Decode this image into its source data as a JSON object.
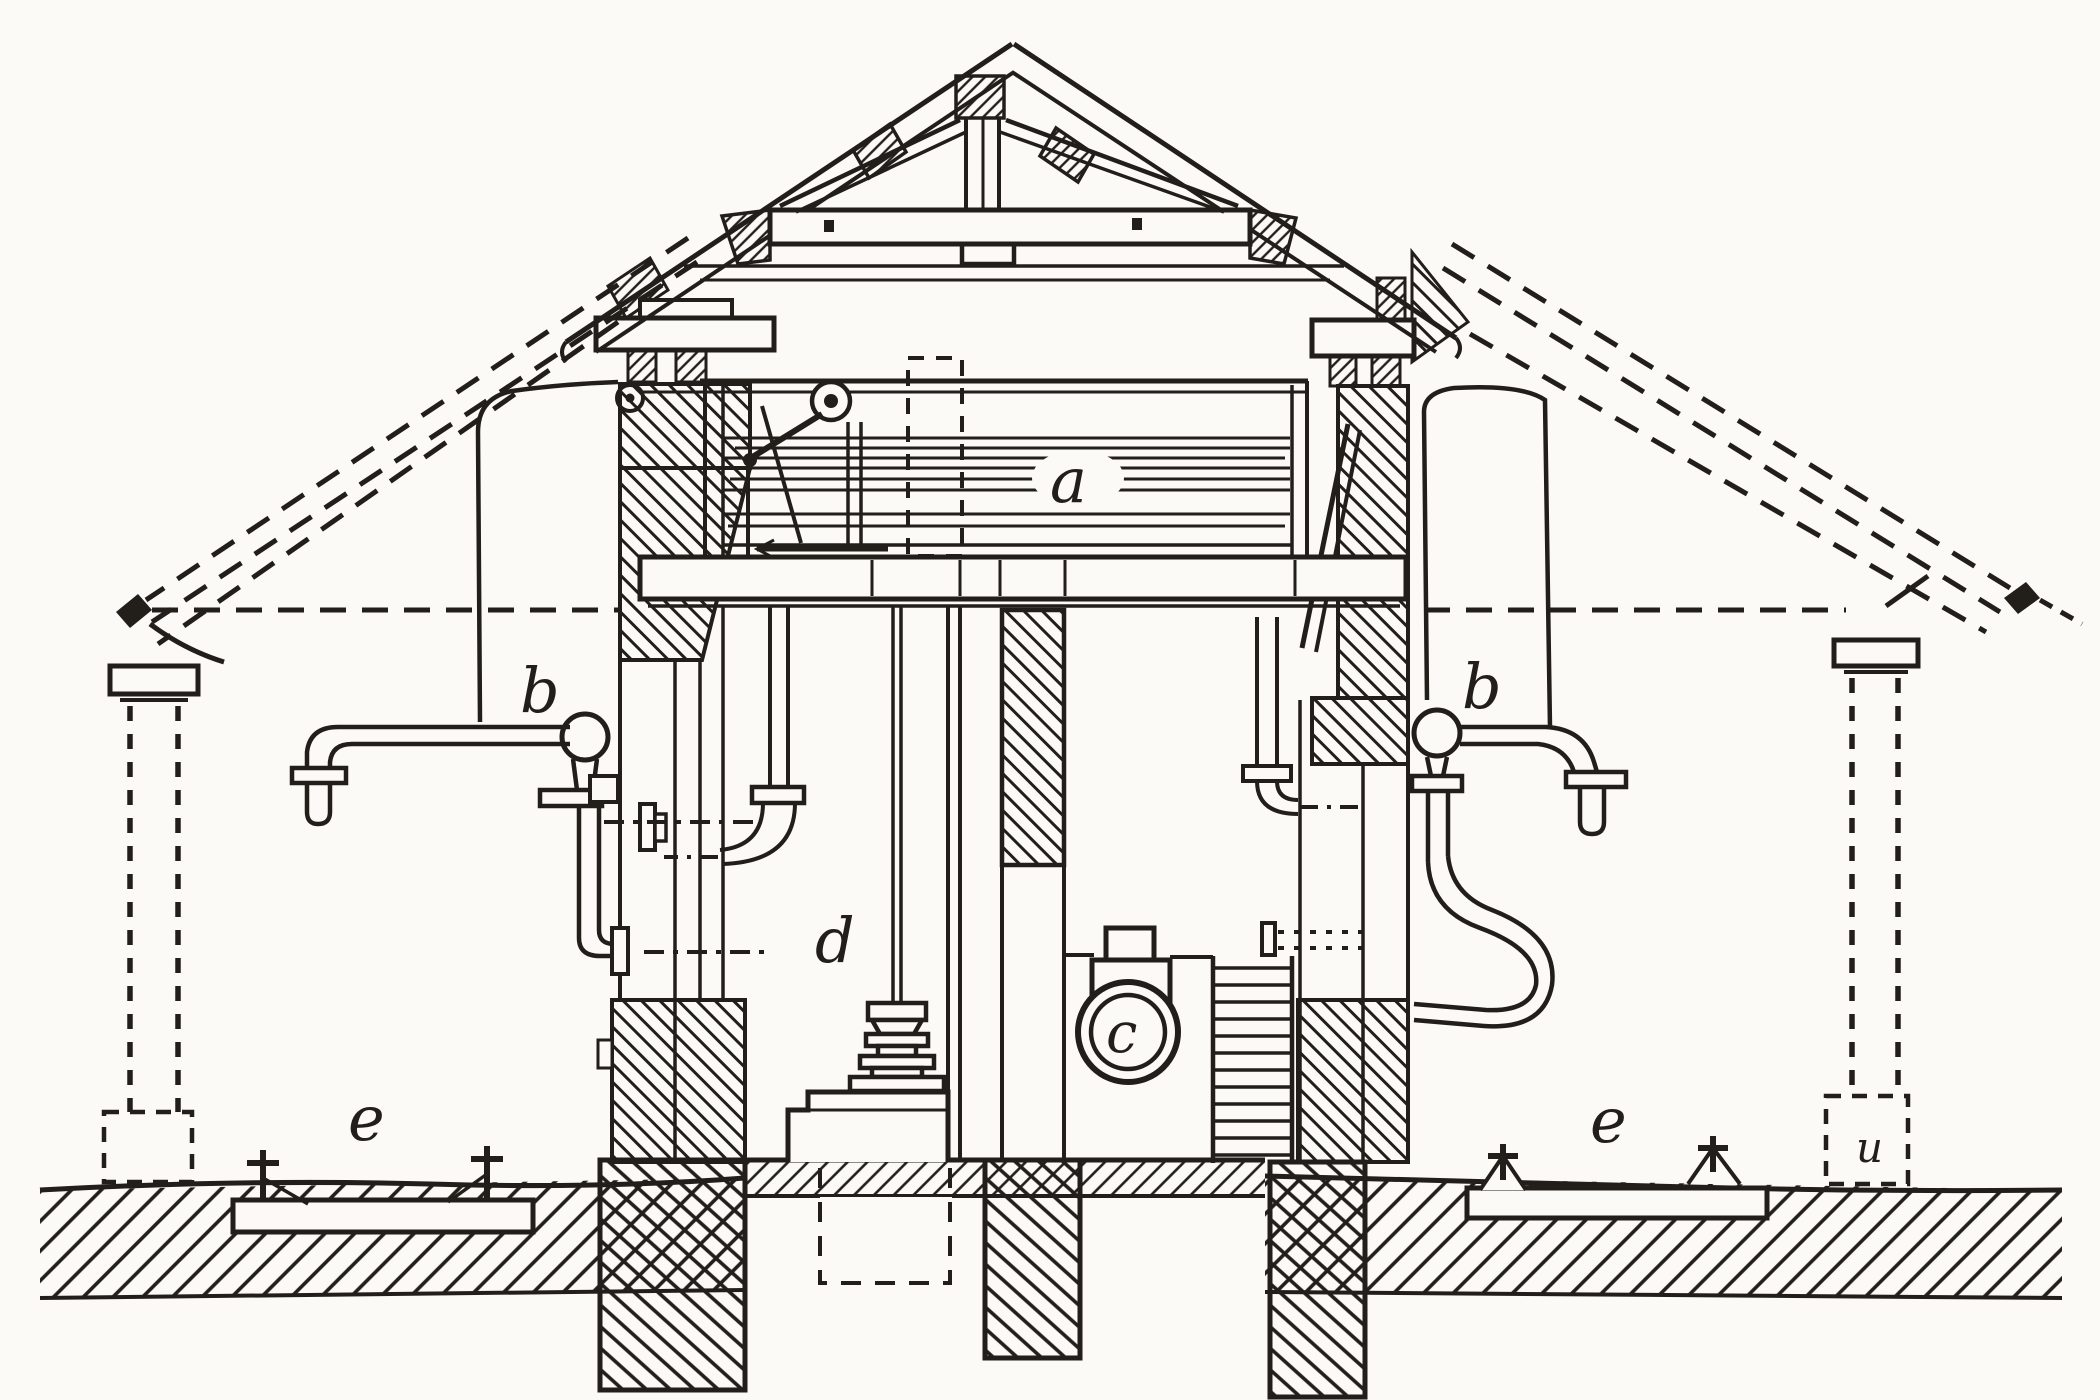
{
  "colors": {
    "ink": "#221f1b",
    "paper": "#fbfaf7"
  },
  "figure": {
    "labels": {
      "a": "a",
      "b_left": "b",
      "b_right": "b",
      "c": "c",
      "d": "d",
      "e_left": "e",
      "e_right": "e",
      "u": "u"
    }
  }
}
